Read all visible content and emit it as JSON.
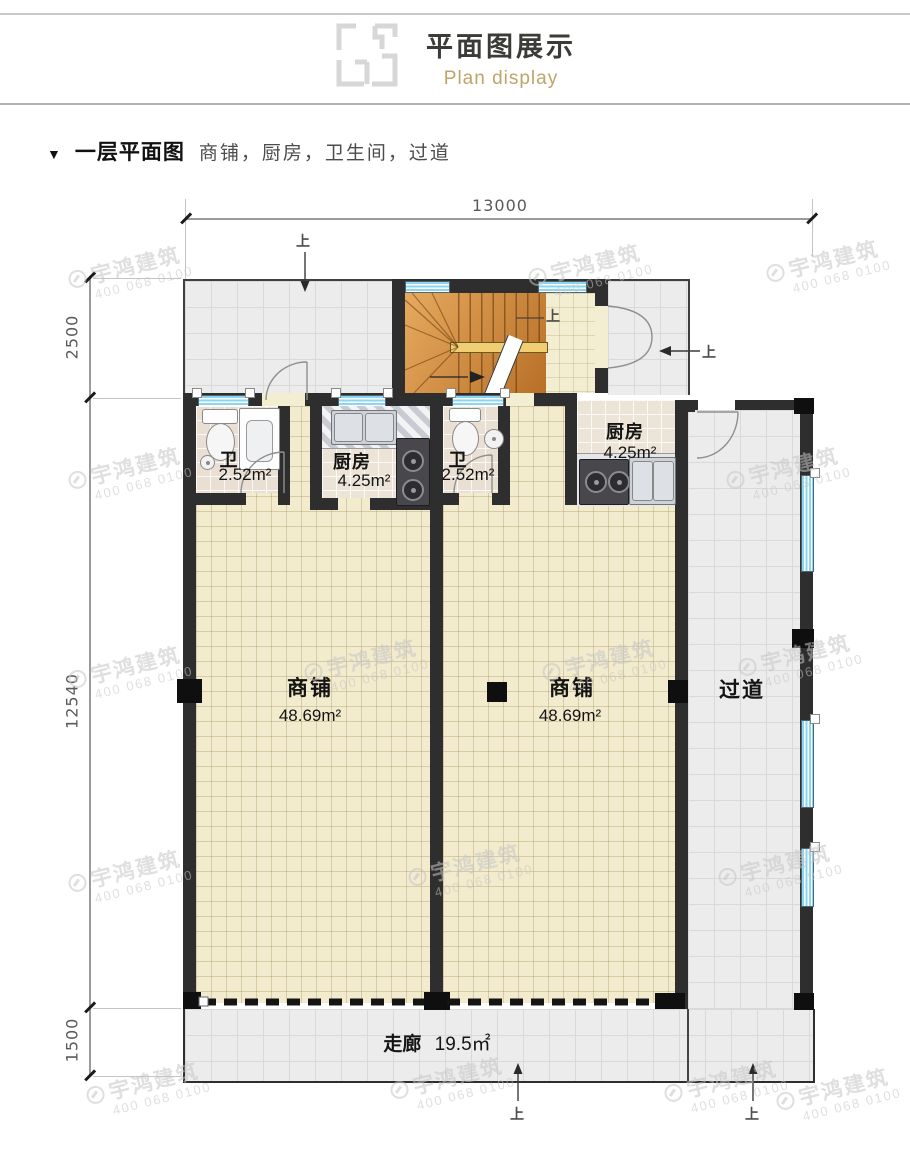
{
  "header": {
    "title": "平面图展示",
    "subtitle": "Plan display"
  },
  "section": {
    "marker": "▼",
    "title": "一层平面图",
    "description": "商铺，厨房，卫生间，过道"
  },
  "dimensions": {
    "top_width": "13000",
    "left_top": "2500",
    "left_middle": "12540",
    "left_bottom": "1500"
  },
  "annotations": {
    "up": "上"
  },
  "rooms": {
    "bath_left": {
      "name": "卫",
      "area": "2.52m²"
    },
    "kitchen_left": {
      "name": "厨房",
      "area": "4.25m²"
    },
    "bath_mid": {
      "name": "卫",
      "area": "2.52m²"
    },
    "kitchen_right": {
      "name": "厨房",
      "area": "4.25m²"
    },
    "shop_left": {
      "name": "商铺",
      "area": "48.69m²"
    },
    "shop_right": {
      "name": "商铺",
      "area": "48.69m²"
    },
    "passage": {
      "name": "过道"
    },
    "corridor": {
      "name": "走廊",
      "area": "19.5㎡"
    }
  },
  "watermark": {
    "brand": "宇鸿建筑",
    "phone": "400 068 0100"
  },
  "colors": {
    "accent_gold": "#bfa468",
    "wall": "#2e2e2e",
    "window_blue": "#8ad5f1",
    "floor_cream": "#f2ebcd",
    "floor_gray": "#ececec",
    "stair_wood": "#cd8940"
  }
}
